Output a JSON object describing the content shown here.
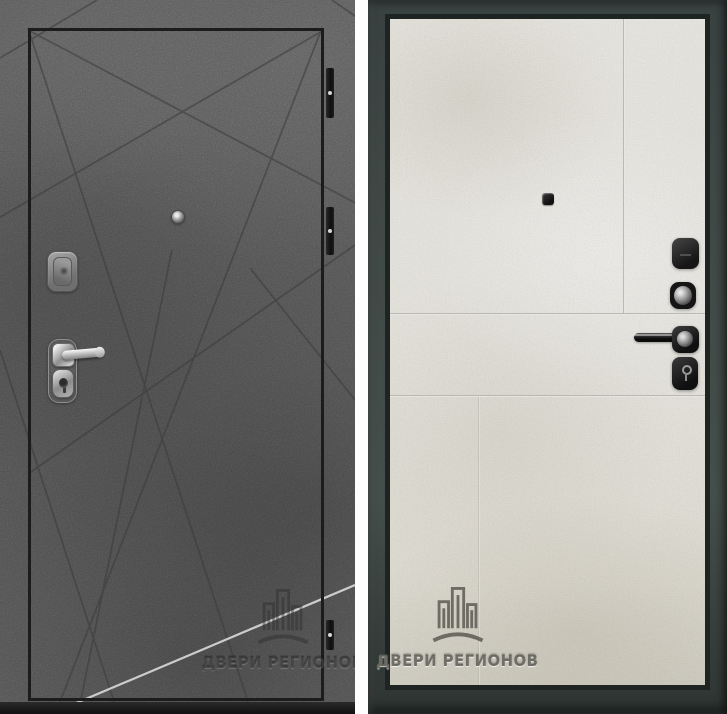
{
  "photo": {
    "description": "Product photo of a steel entry door shown from both sides",
    "left_panel": {
      "side": "exterior",
      "finish": "dark gray concrete with diagonal criss-cross grooves",
      "leaf_outline": "thin black rectangle",
      "hinges_count": "3",
      "hardware": [
        "peephole",
        "upper lock escutcheon",
        "chrome lever handle",
        "key cylinder"
      ]
    },
    "right_panel": {
      "side": "interior",
      "finish": "light cream stone panel inside a dark gray-green frame",
      "hardware": [
        "square peephole",
        "thumb-turn escutcheon",
        "key cylinder",
        "black lever handle",
        "keyhole escutcheon"
      ]
    }
  },
  "watermark": {
    "text": "ДВЕРИ РЕГИОНОВ",
    "logo": "city-buildings-logo"
  },
  "colors": {
    "concrete_gray": "#7d7d7d",
    "leaf_outline": "#1c1c1c",
    "interior_panel": "#efede6",
    "frame_dark": "#3f4845",
    "divider_white": "#fefefe"
  }
}
